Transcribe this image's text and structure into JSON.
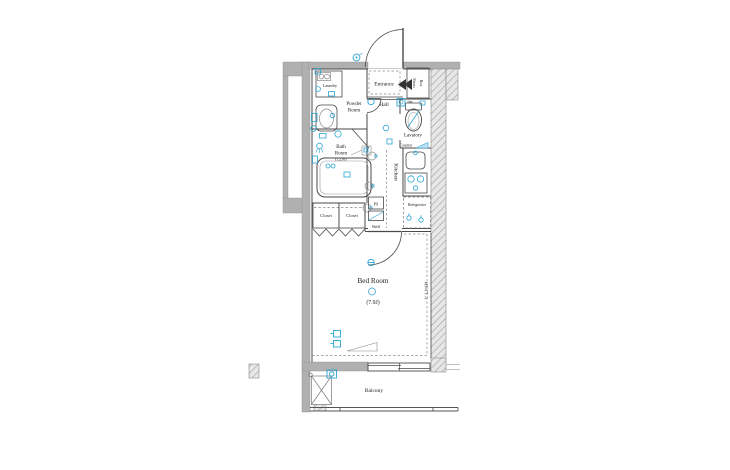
{
  "colors": {
    "background": "#ffffff",
    "wall_gray": "#b0b0b0",
    "line_dark": "#4a4a4a",
    "fixture_blue": "#2aa4d4",
    "hatch_line": "#9a9a9a"
  },
  "floor_plan": {
    "labels": {
      "entrance": "Entrance",
      "shoes_box_line1": "Shoes",
      "shoes_box_line2": "Box",
      "hall": "Hall",
      "laundry": "Laundry",
      "powder_room_line1": "Powder",
      "powder_room_line2": "Room",
      "bath_room_line1": "Bath",
      "bath_room_line2": "Room",
      "bath_room_size": "(1216)",
      "lavatory": "Lavatory",
      "sink": "Sink",
      "counter": "Counter",
      "kitchen": "Kitchen",
      "refrigerator": "Refrigerator",
      "closet_1": "Closet",
      "closet_2": "Closet",
      "ps": "PS",
      "shelf": "Shelf",
      "bed_room": "Bed Room",
      "bed_room_size": "(7.9J)",
      "balcony": "Balcony",
      "ac_wall_note": "エアコン"
    }
  }
}
